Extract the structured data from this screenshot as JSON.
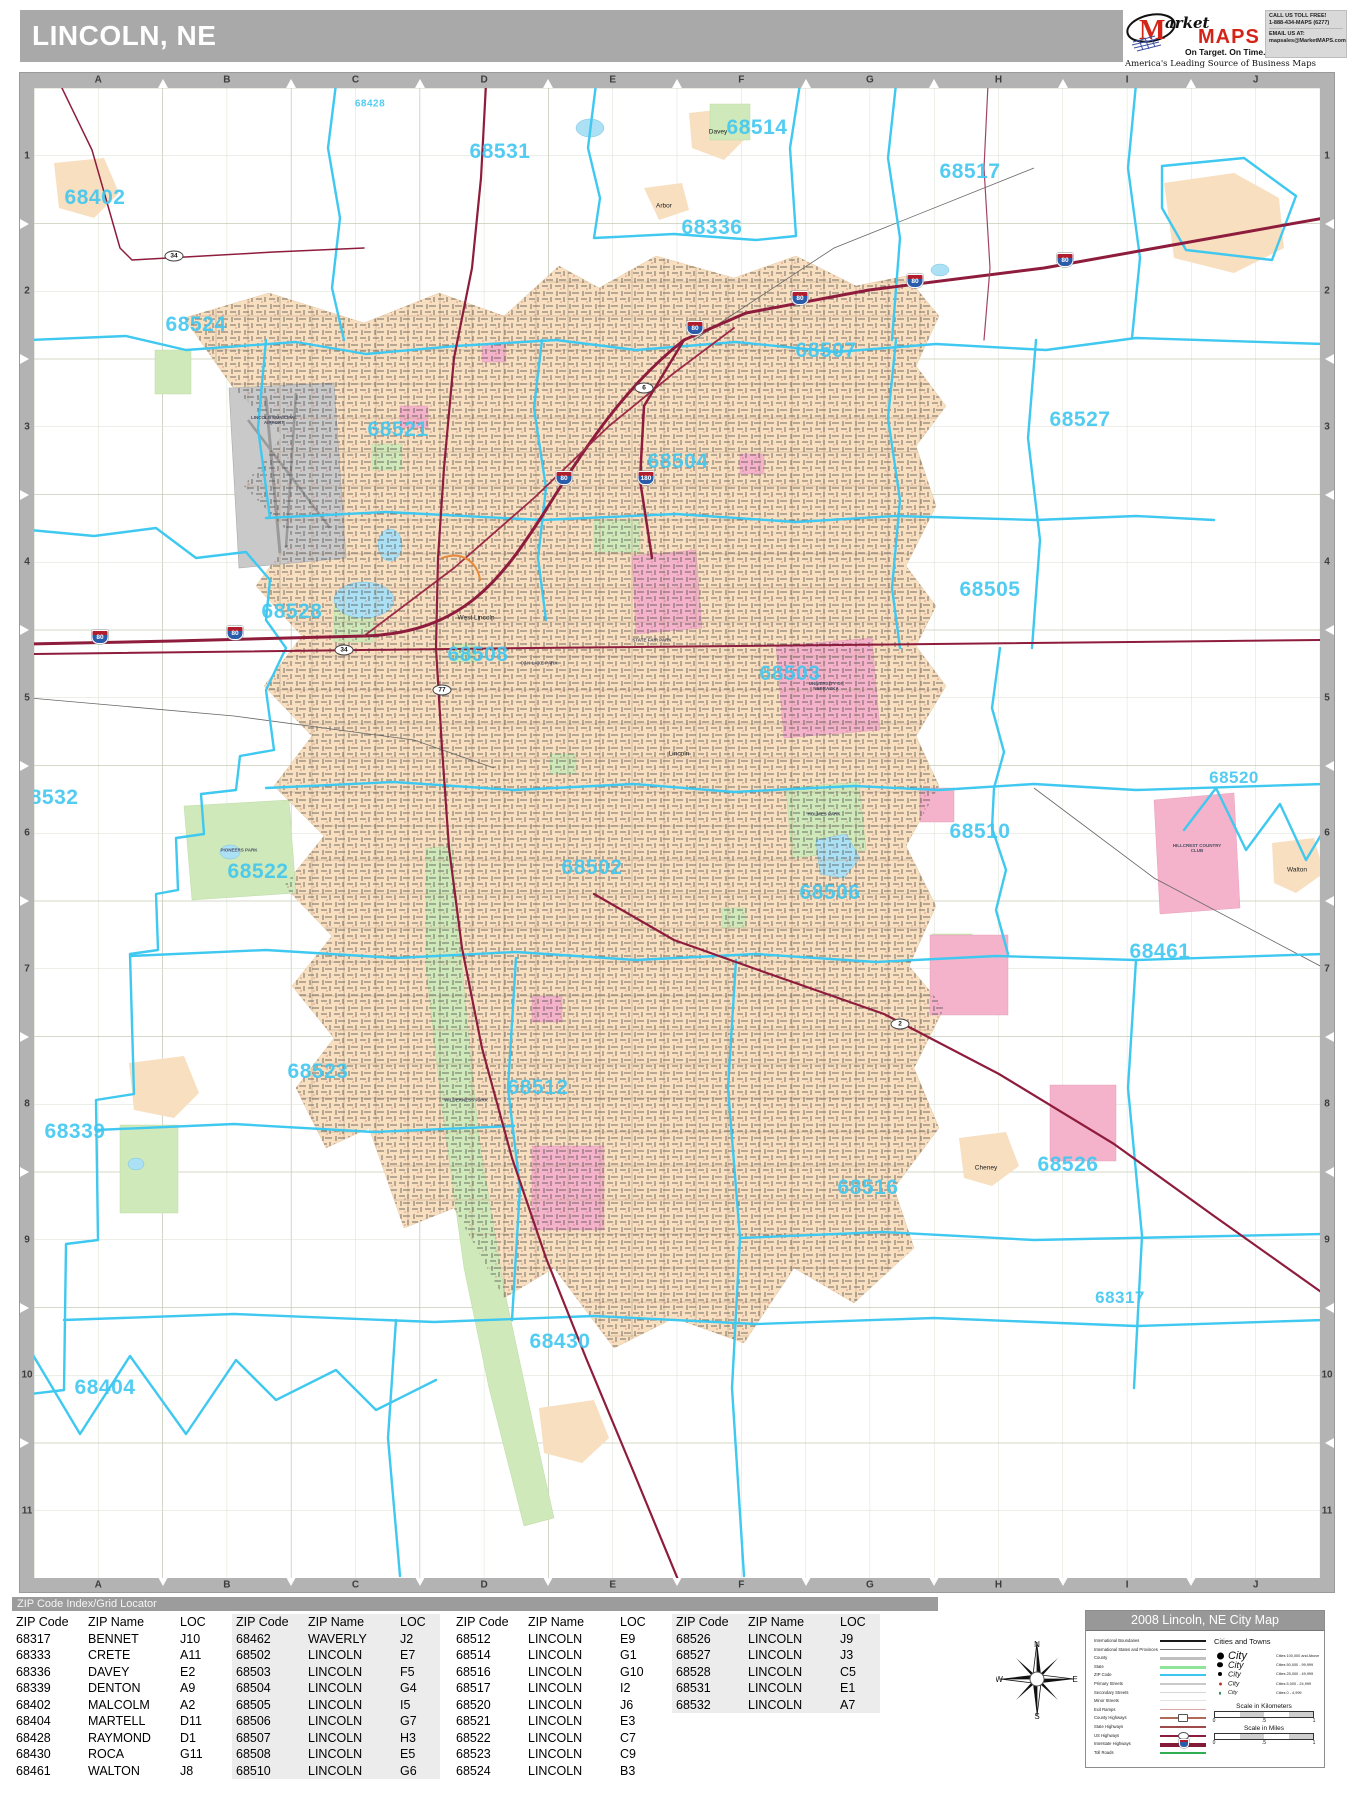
{
  "page": {
    "title": "LINCOLN, NE"
  },
  "logo": {
    "m": "M",
    "brand_market": "arket",
    "brand_maps": "MAPS",
    "tagline": "On Target.  On Time.",
    "subtitle": "America's Leading Source of  Business Maps",
    "contact_call": "CALL US TOLL FREE!",
    "contact_phone": "1-888-434-MAPS (6277)",
    "contact_email_label": "EMAIL US AT:",
    "contact_email": "mapsales@MarketMAPS.com"
  },
  "colors": {
    "header_gray": "#a9a9a9",
    "zip_boundary": "#3fc8f0",
    "zip_label": "#41c7f0",
    "urban_fill": "#f7dfc0",
    "highway": "#8e1c3c",
    "park_green": "#cfe9ba",
    "campus_pink": "#f4b3ca",
    "water_blue": "#ace0f4",
    "airport_gray": "#c9c9c9"
  },
  "map": {
    "grid_columns": [
      "A",
      "B",
      "C",
      "D",
      "E",
      "F",
      "G",
      "H",
      "I",
      "J"
    ],
    "grid_rows": [
      "1",
      "2",
      "3",
      "4",
      "5",
      "6",
      "7",
      "8",
      "9",
      "10",
      "11"
    ],
    "zip_labels": [
      {
        "text": "68428",
        "x": 336,
        "y": 16,
        "size": 10
      },
      {
        "text": "68531",
        "x": 466,
        "y": 64,
        "size": 21
      },
      {
        "text": "68514",
        "x": 723,
        "y": 40,
        "size": 21
      },
      {
        "text": "68517",
        "x": 936,
        "y": 84,
        "size": 21
      },
      {
        "text": "68402",
        "x": 61,
        "y": 110,
        "size": 21
      },
      {
        "text": "68336",
        "x": 678,
        "y": 140,
        "size": 21
      },
      {
        "text": "68524",
        "x": 162,
        "y": 237,
        "size": 21
      },
      {
        "text": "68507",
        "x": 792,
        "y": 263,
        "size": 21
      },
      {
        "text": "68527",
        "x": 1046,
        "y": 332,
        "size": 21
      },
      {
        "text": "68521",
        "x": 364,
        "y": 342,
        "size": 21
      },
      {
        "text": "68504",
        "x": 644,
        "y": 374,
        "size": 21
      },
      {
        "text": "68505",
        "x": 956,
        "y": 502,
        "size": 21
      },
      {
        "text": "68528",
        "x": 258,
        "y": 524,
        "size": 21
      },
      {
        "text": "68508",
        "x": 444,
        "y": 567,
        "size": 21
      },
      {
        "text": "68503",
        "x": 756,
        "y": 586,
        "size": 21
      },
      {
        "text": "68510",
        "x": 946,
        "y": 744,
        "size": 21
      },
      {
        "text": "68520",
        "x": 1200,
        "y": 690,
        "size": 17
      },
      {
        "text": "68532",
        "x": 14,
        "y": 710,
        "size": 21
      },
      {
        "text": "68522",
        "x": 224,
        "y": 784,
        "size": 21
      },
      {
        "text": "68502",
        "x": 558,
        "y": 780,
        "size": 21
      },
      {
        "text": "68506",
        "x": 796,
        "y": 805,
        "size": 21
      },
      {
        "text": "68461",
        "x": 1126,
        "y": 864,
        "size": 21
      },
      {
        "text": "68523",
        "x": 284,
        "y": 984,
        "size": 21
      },
      {
        "text": "68339",
        "x": 41,
        "y": 1044,
        "size": 21
      },
      {
        "text": "68512",
        "x": 504,
        "y": 1000,
        "size": 21
      },
      {
        "text": "68516",
        "x": 834,
        "y": 1100,
        "size": 21
      },
      {
        "text": "68526",
        "x": 1034,
        "y": 1077,
        "size": 21
      },
      {
        "text": "68317",
        "x": 1086,
        "y": 1210,
        "size": 17
      },
      {
        "text": "68404",
        "x": 71,
        "y": 1300,
        "size": 21
      },
      {
        "text": "68430",
        "x": 526,
        "y": 1254,
        "size": 21
      }
    ],
    "town_labels": [
      {
        "text": "Arbor",
        "x": 630,
        "y": 118
      },
      {
        "text": "Davey",
        "x": 684,
        "y": 44
      },
      {
        "text": "West Lincoln",
        "x": 442,
        "y": 530
      },
      {
        "text": "Lincoln",
        "x": 645,
        "y": 666
      },
      {
        "text": "Walton",
        "x": 1263,
        "y": 782
      },
      {
        "text": "Cheney",
        "x": 952,
        "y": 1080
      }
    ],
    "poi_labels": [
      {
        "text": "LINCOLN MUNICIPAL AIRPORT",
        "x": 240,
        "y": 332
      },
      {
        "text": "STATE FAIR PARK",
        "x": 618,
        "y": 552
      },
      {
        "text": "OAK LAKE PARK",
        "x": 505,
        "y": 575
      },
      {
        "text": "UNIVERSITY OF NEBRASKA",
        "x": 792,
        "y": 598
      },
      {
        "text": "HILLCREST COUNTRY CLUB",
        "x": 1163,
        "y": 760
      },
      {
        "text": "PIONEERS PARK",
        "x": 205,
        "y": 762
      },
      {
        "text": "HOLMES PARK",
        "x": 790,
        "y": 726
      },
      {
        "text": "WILDERNESS PARK",
        "x": 432,
        "y": 1012
      }
    ],
    "route_shields": [
      {
        "text": "80",
        "kind": "interstate",
        "x": 66,
        "y": 549
      },
      {
        "text": "80",
        "kind": "interstate",
        "x": 201,
        "y": 545
      },
      {
        "text": "80",
        "kind": "interstate",
        "x": 530,
        "y": 390
      },
      {
        "text": "80",
        "kind": "interstate",
        "x": 661,
        "y": 240
      },
      {
        "text": "80",
        "kind": "interstate",
        "x": 766,
        "y": 210
      },
      {
        "text": "80",
        "kind": "interstate",
        "x": 881,
        "y": 193
      },
      {
        "text": "80",
        "kind": "interstate",
        "x": 1031,
        "y": 172
      },
      {
        "text": "180",
        "kind": "interstate",
        "x": 612,
        "y": 390
      },
      {
        "text": "34",
        "kind": "oval",
        "x": 310,
        "y": 562
      },
      {
        "text": "34",
        "kind": "oval",
        "x": 140,
        "y": 168
      },
      {
        "text": "77",
        "kind": "oval",
        "x": 408,
        "y": 602
      },
      {
        "text": "6",
        "kind": "oval",
        "x": 610,
        "y": 300
      },
      {
        "text": "2",
        "kind": "oval",
        "x": 866,
        "y": 936
      }
    ]
  },
  "index": {
    "header": "ZIP Code Index/Grid Locator",
    "col_headers": [
      "ZIP Code",
      "ZIP Name",
      "LOC"
    ],
    "groups": [
      {
        "shaded": false,
        "x": 12,
        "rows": [
          [
            "68317",
            "BENNET",
            "J10"
          ],
          [
            "68333",
            "CRETE",
            "A11"
          ],
          [
            "68336",
            "DAVEY",
            "E2"
          ],
          [
            "68339",
            "DENTON",
            "A9"
          ],
          [
            "68402",
            "MALCOLM",
            "A2"
          ],
          [
            "68404",
            "MARTELL",
            "D11"
          ],
          [
            "68428",
            "RAYMOND",
            "D1"
          ],
          [
            "68430",
            "ROCA",
            "G11"
          ],
          [
            "68461",
            "WALTON",
            "J8"
          ]
        ]
      },
      {
        "shaded": true,
        "x": 232,
        "rows": [
          [
            "68462",
            "WAVERLY",
            "J2"
          ],
          [
            "68502",
            "LINCOLN",
            "E7"
          ],
          [
            "68503",
            "LINCOLN",
            "F5"
          ],
          [
            "68504",
            "LINCOLN",
            "G4"
          ],
          [
            "68505",
            "LINCOLN",
            "I5"
          ],
          [
            "68506",
            "LINCOLN",
            "G7"
          ],
          [
            "68507",
            "LINCOLN",
            "H3"
          ],
          [
            "68508",
            "LINCOLN",
            "E5"
          ],
          [
            "68510",
            "LINCOLN",
            "G6"
          ]
        ]
      },
      {
        "shaded": false,
        "x": 452,
        "rows": [
          [
            "68512",
            "LINCOLN",
            "E9"
          ],
          [
            "68514",
            "LINCOLN",
            "G1"
          ],
          [
            "68516",
            "LINCOLN",
            "G10"
          ],
          [
            "68517",
            "LINCOLN",
            "I2"
          ],
          [
            "68520",
            "LINCOLN",
            "J6"
          ],
          [
            "68521",
            "LINCOLN",
            "E3"
          ],
          [
            "68522",
            "LINCOLN",
            "C7"
          ],
          [
            "68523",
            "LINCOLN",
            "C9"
          ],
          [
            "68524",
            "LINCOLN",
            "B3"
          ]
        ]
      },
      {
        "shaded": true,
        "x": 672,
        "rows": [
          [
            "68526",
            "LINCOLN",
            "J9"
          ],
          [
            "68527",
            "LINCOLN",
            "J3"
          ],
          [
            "68528",
            "LINCOLN",
            "C5"
          ],
          [
            "68531",
            "LINCOLN",
            "E1"
          ],
          [
            "68532",
            "LINCOLN",
            "A7"
          ]
        ]
      }
    ]
  },
  "compass": {
    "n": "N",
    "e": "E",
    "s": "S",
    "w": "W"
  },
  "legend": {
    "title": "2008 Lincoln, NE City Map",
    "line_items": [
      {
        "label": "International Boundaries",
        "color": "#1a1a1a",
        "h": 1.5,
        "badge": ""
      },
      {
        "label": "International States and Provinces",
        "color": "#777777",
        "h": 1,
        "badge": ""
      },
      {
        "label": "County",
        "color": "#c0c0c0",
        "h": 3,
        "badge": ""
      },
      {
        "label": "State",
        "color": "#8ee59a",
        "h": 3.5,
        "badge": ""
      },
      {
        "label": "ZIP Code",
        "color": "#3cc6f0",
        "h": 2,
        "badge": ""
      },
      {
        "label": "Primary Streets",
        "color": "#c9c9c9",
        "h": 2,
        "badge": ""
      },
      {
        "label": "Secondary Streets",
        "color": "#d8d8d8",
        "h": 1.4,
        "badge": ""
      },
      {
        "label": "Minor Streets",
        "color": "#e3e3e3",
        "h": 1,
        "badge": ""
      },
      {
        "label": "Exit Ramps",
        "color": "#dba8a8",
        "h": 1.2,
        "badge": ""
      },
      {
        "label": "County Highways",
        "color": "#b06a5a",
        "h": 1.5,
        "badge": "sq"
      },
      {
        "label": "State Highways",
        "color": "#9c4a4a",
        "h": 1.5,
        "badge": ""
      },
      {
        "label": "US Highways",
        "color": "#8e1c3c",
        "h": 2,
        "badge": "ov"
      },
      {
        "label": "Interstate Highways",
        "color": "#821a38",
        "h": 3.5,
        "badge": "sh"
      },
      {
        "label": "Toll Roads",
        "color": "#2fae52",
        "h": 2.5,
        "badge": ""
      }
    ],
    "cities_header": "Cities and Towns",
    "city_classes": [
      {
        "label": "City",
        "range": "Cities 100,000 and Above",
        "dot": 7,
        "color": "#000000",
        "font": 11
      },
      {
        "label": "City",
        "range": "Cities 50,000 - 99,999",
        "dot": 5.5,
        "color": "#000000",
        "font": 9
      },
      {
        "label": "City",
        "range": "Cities 25,000 - 49,999",
        "dot": 4,
        "color": "#000000",
        "font": 7.5
      },
      {
        "label": "City",
        "range": "Cities 5,000 - 24,999",
        "dot": 3,
        "color": "#c0392b",
        "font": 6.5
      },
      {
        "label": "City",
        "range": "Cities 0 - 4,999",
        "dot": 2.5,
        "color": "#2e8b57",
        "font": 5.5
      }
    ],
    "scale_km": {
      "title": "Scale in Kilometers",
      "ticks": [
        "0",
        ".5",
        "1"
      ]
    },
    "scale_mi": {
      "title": "Scale in Miles",
      "ticks": [
        "0",
        ".5",
        "1"
      ]
    }
  }
}
